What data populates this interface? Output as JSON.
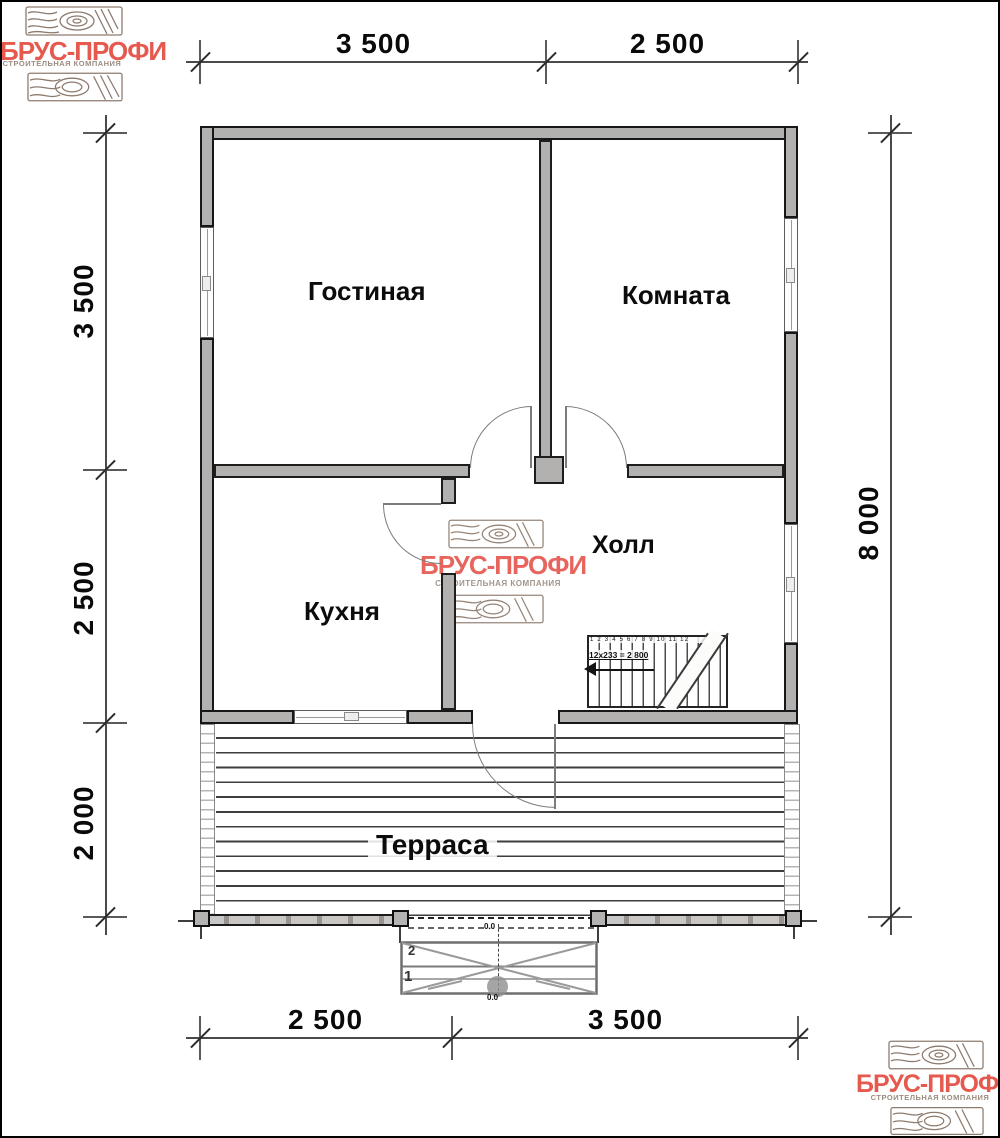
{
  "brand": {
    "name": "БРУС-ПРОФИ",
    "tagline": "СТРОИТЕЛЬНАЯ КОМПАНИЯ",
    "accent_color": "#e6594f",
    "tagline_color": "#9b8c80",
    "wood_color": "#8d7b6e"
  },
  "rooms": [
    {
      "name": "Гостиная"
    },
    {
      "name": "Комната"
    },
    {
      "name": "Кухня"
    },
    {
      "name": "Холл"
    },
    {
      "name": "Терраса"
    }
  ],
  "dimensions": {
    "top": [
      "3 500",
      "2 500"
    ],
    "bottom": [
      "2 500",
      "3 500"
    ],
    "left": [
      "3 500",
      "2 500",
      "2 000"
    ],
    "right": [
      "8 000"
    ]
  },
  "stairs": {
    "step_numbers": "1 2 3 4 5 6 7 8 9 10 11 12",
    "formula": "12x233 = 2 800"
  },
  "entrance": {
    "steps": [
      "2",
      "1"
    ],
    "level_top": "0.0",
    "level_bottom": "0.0"
  },
  "drawing_colors": {
    "wall_fill": "#b3b1af",
    "line": "#1c1c1c"
  }
}
